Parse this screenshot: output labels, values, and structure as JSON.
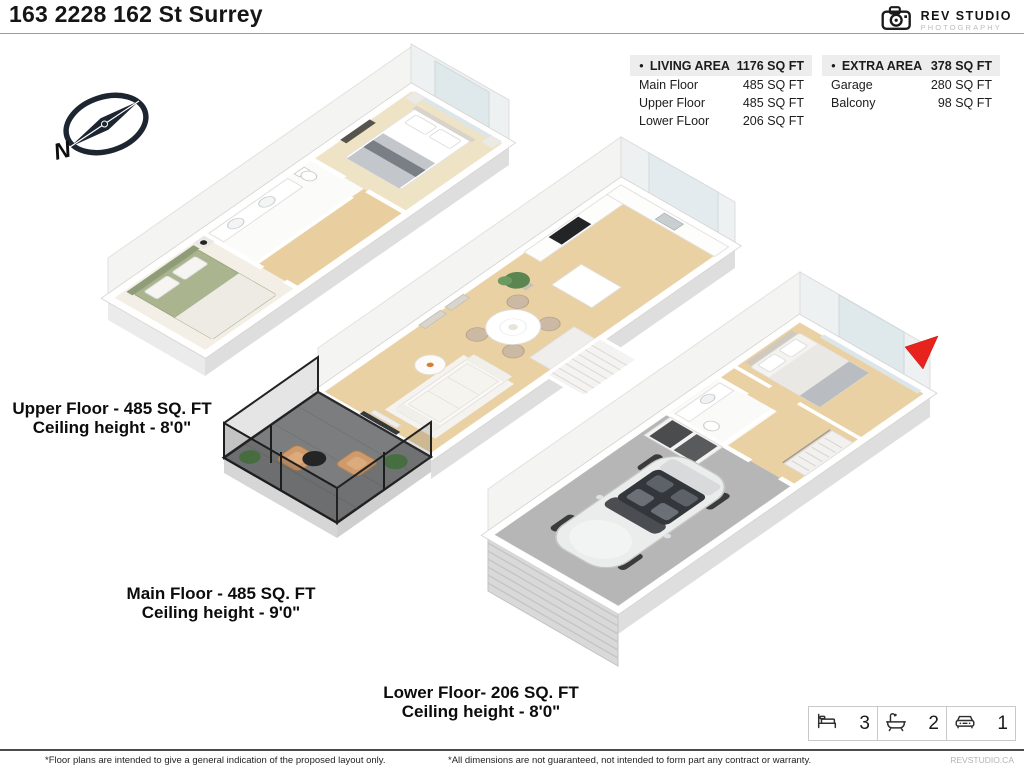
{
  "header": {
    "title": "163 2228 162 St Surrey"
  },
  "logo": {
    "brand": "REV STUDIO",
    "subtitle": "PHOTOGRAPHY"
  },
  "tables": {
    "living": {
      "header": {
        "bullet": "●",
        "label": "LIVING AREA",
        "value": "1176 SQ FT"
      },
      "rows": [
        {
          "label": "Main Floor",
          "value": "485 SQ FT"
        },
        {
          "label": "Upper Floor",
          "value": "485 SQ FT"
        },
        {
          "label": "Lower FLoor",
          "value": "206 SQ FT"
        }
      ]
    },
    "extra": {
      "header": {
        "bullet": "●",
        "label": "EXTRA AREA",
        "value": "378 SQ FT"
      },
      "rows": [
        {
          "label": "Garage",
          "value": "280 SQ FT"
        },
        {
          "label": "Balcony",
          "value": "98 SQ FT"
        }
      ]
    }
  },
  "floors": {
    "upper": {
      "line1": "Upper Floor - 485 SQ. FT",
      "line2": "Ceiling height - 8'0\""
    },
    "main": {
      "line1": "Main Floor - 485 SQ. FT",
      "line2": "Ceiling height - 9'0\""
    },
    "lower": {
      "line1": "Lower Floor- 206 SQ. FT",
      "line2": "Ceiling height - 8'0\""
    }
  },
  "compass": {
    "label": "N"
  },
  "summary": {
    "beds": "3",
    "baths": "2",
    "garage": "1"
  },
  "footer": {
    "left": "*Floor plans are intended to give a general indication of the proposed layout only.",
    "center": "*All dimensions are not guaranteed, not intended to form part any contract or warranty.",
    "website": "REVSTUDIO.CA"
  },
  "colors": {
    "accent_red": "#e8231d",
    "wood_floor": "#ead1a3",
    "garage_floor": "#b6b6b7",
    "balcony_floor": "#7b7d7e",
    "sage_bed": "#aab58f"
  }
}
